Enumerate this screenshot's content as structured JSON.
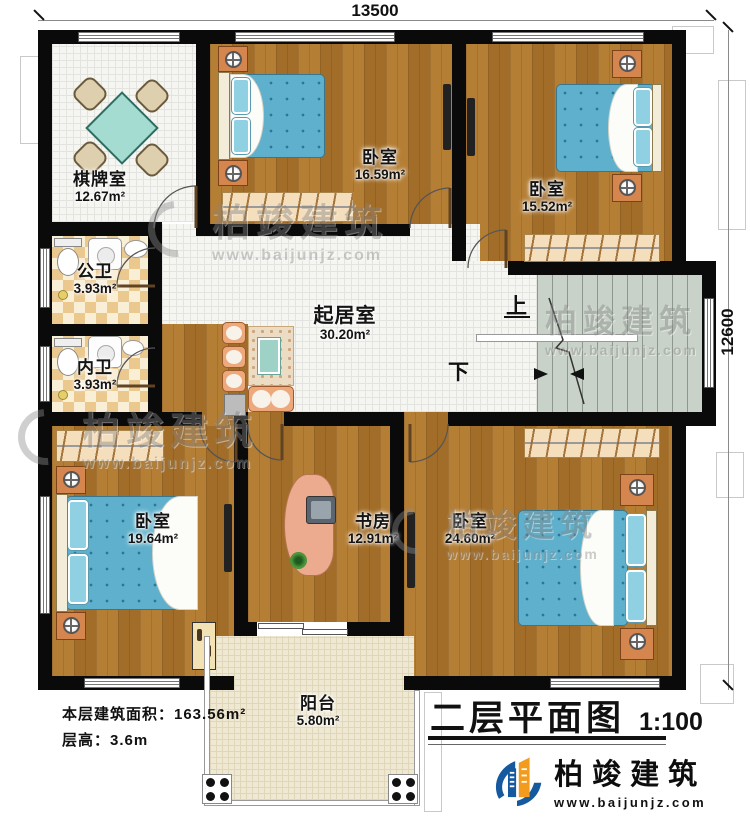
{
  "plan": {
    "dimensions": {
      "width_label": "13500",
      "height_label": "12600"
    },
    "rooms": [
      {
        "name": "棋牌室",
        "area": "12.67m²"
      },
      {
        "name": "卧室",
        "area": "16.59m²"
      },
      {
        "name": "卧室",
        "area": "15.52m²"
      },
      {
        "name": "公卫",
        "area": "3.93m²"
      },
      {
        "name": "内卫",
        "area": "3.93m²"
      },
      {
        "name": "起居室",
        "area": "30.20m²"
      },
      {
        "name": "卧室",
        "area": "19.64m²"
      },
      {
        "name": "书房",
        "area": "12.91m²"
      },
      {
        "name": "卧室",
        "area": "24.60m²"
      },
      {
        "name": "阳台",
        "area": "5.80m²"
      }
    ],
    "stairs": {
      "up_label": "上",
      "down_label": "下"
    }
  },
  "notes": {
    "floor_area": "本层建筑面积：163.56m²",
    "floor_height": "层高：3.6m"
  },
  "title_block": {
    "title": "二层平面图",
    "scale": "1:100"
  },
  "brand": {
    "name": "柏竣建筑",
    "website": "www.baijunjz.com"
  },
  "colors": {
    "wall": "#0a0a0a",
    "wood_floor": "#ad7630",
    "tile_floor": "#f5f5f2",
    "bath_tile": "#ebc88e",
    "stair_floor": "#c9d2c9",
    "balcony_floor": "#efe9d4",
    "bed_blue": "#5fb0cc",
    "nightstand_orange": "#d5854e",
    "logo_blue": "#15599f",
    "logo_orange": "#f29b1d"
  }
}
